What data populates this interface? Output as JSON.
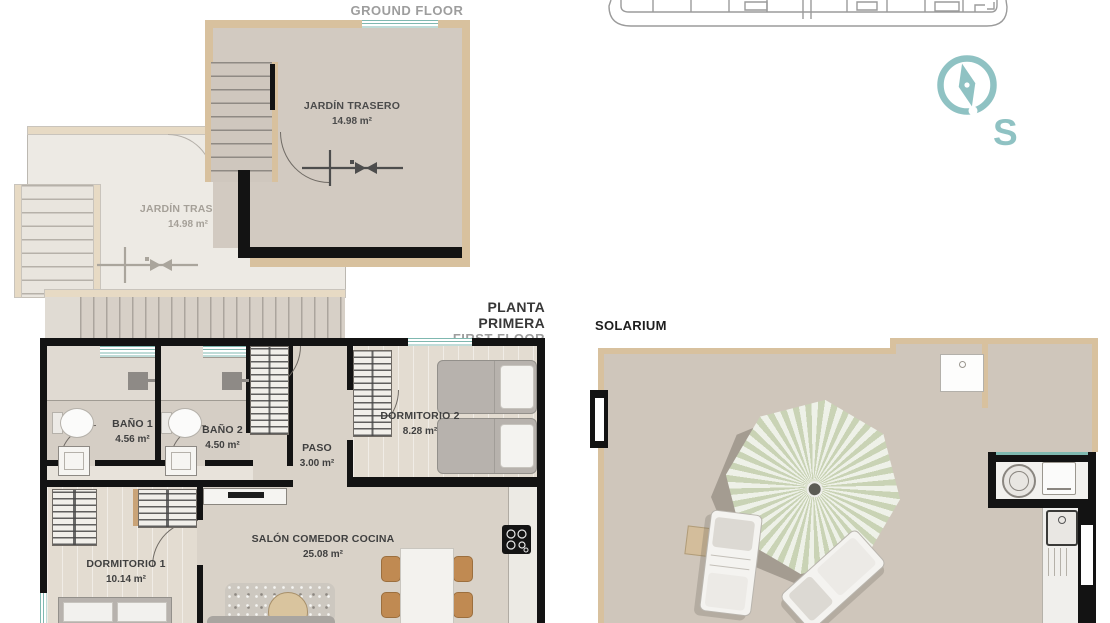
{
  "titles": {
    "ground_floor": {
      "primary": "PLANTA BAJA",
      "secondary": "GROUND FLOOR"
    },
    "first_floor": {
      "primary": "PLANTA PRIMERA",
      "secondary": "FIRST FLOOR"
    },
    "solarium": "SOLARIUM"
  },
  "compass": {
    "cardinal_label": "S"
  },
  "ground_floor": {
    "unit_back": {
      "jardin": {
        "name": "JARDÍN TRASERO",
        "area": "14.98 m²"
      }
    },
    "unit_front": {
      "jardin": {
        "name": "JARDÍN TRASERO",
        "area": "14.98 m²"
      }
    }
  },
  "first_floor": {
    "bano1": {
      "name": "BAÑO 1",
      "area": "4.56 m²"
    },
    "bano2": {
      "name": "BAÑO 2",
      "area": "4.50 m²"
    },
    "paso": {
      "name": "PASO",
      "area": "3.00 m²"
    },
    "dormitorio2": {
      "name": "DORMITORIO 2",
      "area": "8.28 m²"
    },
    "dormitorio1": {
      "name": "DORMITORIO 1",
      "area": "10.14 m²"
    },
    "salon": {
      "name": "SALÓN COMEDOR COCINA",
      "area": "25.08 m²"
    }
  },
  "colors": {
    "accent_teal": "#8fc2c3",
    "window_teal": "#7fb8b0",
    "wall_tan": "#d8c19e",
    "wall_black": "#131313",
    "parasol_green": "#c9d3b5"
  }
}
